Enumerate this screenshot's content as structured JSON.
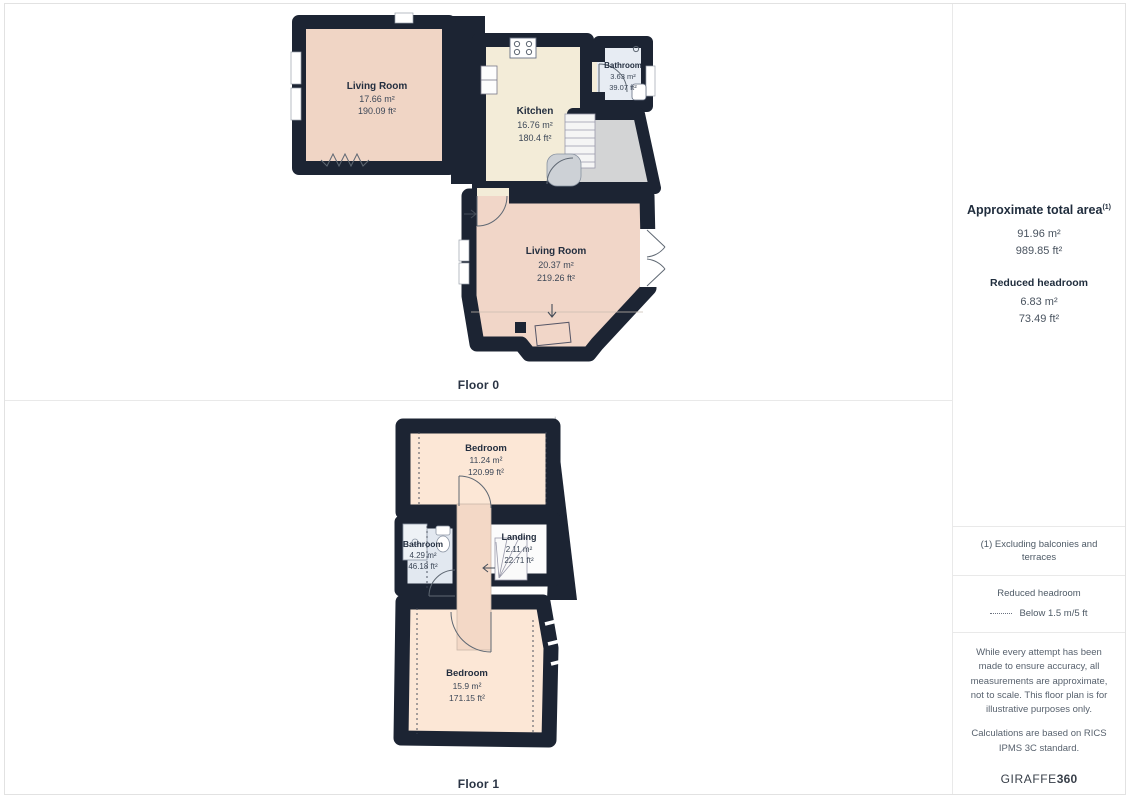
{
  "floor0": {
    "label": "Floor 0",
    "rooms": {
      "living1": {
        "name": "Living Room",
        "m2": "17.66 m²",
        "ft2": "190.09 ft²"
      },
      "kitchen": {
        "name": "Kitchen",
        "m2": "16.76 m²",
        "ft2": "180.4 ft²"
      },
      "bathroom": {
        "name": "Bathroom",
        "m2": "3.63 m²",
        "ft2": "39.07 ft²"
      },
      "living2": {
        "name": "Living Room",
        "m2": "20.37 m²",
        "ft2": "219.26 ft²"
      }
    }
  },
  "floor1": {
    "label": "Floor 1",
    "rooms": {
      "bedroom1": {
        "name": "Bedroom",
        "m2": "11.24 m²",
        "ft2": "120.99 ft²"
      },
      "bathroom": {
        "name": "Bathroom",
        "m2": "4.29 m²",
        "ft2": "46.18 ft²"
      },
      "landing": {
        "name": "Landing",
        "m2": "2.11 m²",
        "ft2": "22.71 ft²"
      },
      "bedroom2": {
        "name": "Bedroom",
        "m2": "15.9 m²",
        "ft2": "171.15 ft²"
      }
    }
  },
  "panel": {
    "total_area": {
      "title": "Approximate total area",
      "sup": "(1)",
      "m2": "91.96 m²",
      "ft2": "989.85 ft²"
    },
    "reduced_headroom": {
      "title": "Reduced headroom",
      "m2": "6.83 m²",
      "ft2": "73.49 ft²"
    },
    "footnote": "(1) Excluding balconies and terraces",
    "legend": {
      "title": "Reduced headroom",
      "label": "Below 1.5 m/5 ft"
    },
    "disclaimer1": "While every attempt has been made to ensure accuracy, all measurements are approximate, not to scale. This floor plan is for illustrative purposes only.",
    "disclaimer2": "Calculations are based on RICS IPMS 3C standard.",
    "brand": {
      "name": "GIRAFFE",
      "suffix": "360"
    }
  },
  "colors": {
    "wall": "#1c2433",
    "living_room_fill": "#f0d5c5",
    "bedroom_fill": "#fce7d6",
    "kitchen_fill": "#f3ecd8",
    "bathroom_fill": "#e7ecf3",
    "reduced_headroom_fill": "#d3d4d5",
    "label_text": "#232e3f",
    "divider": "#e9e9e9"
  }
}
